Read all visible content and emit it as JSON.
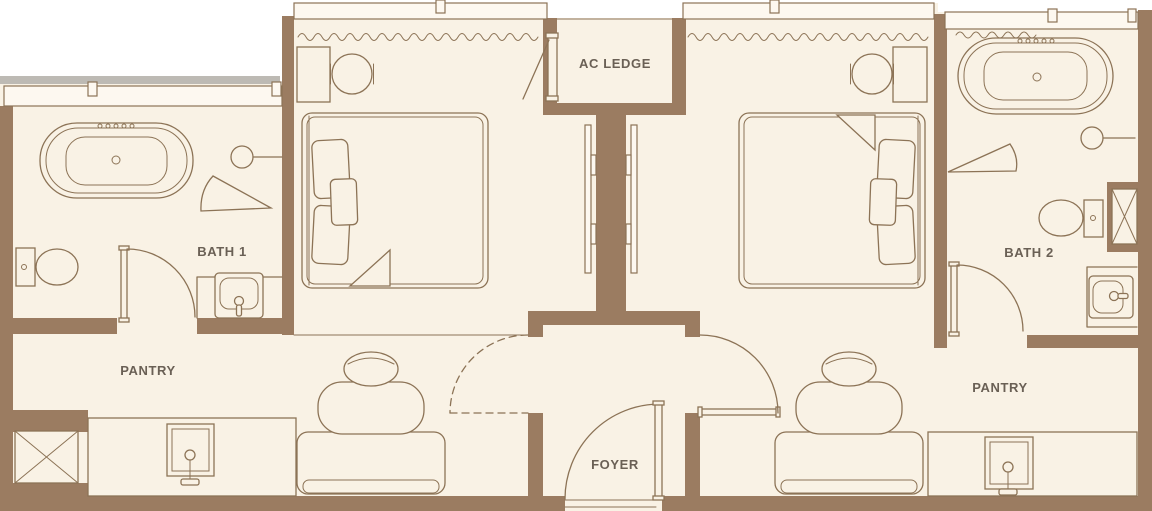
{
  "plan": {
    "type": "apartment-floor-plan",
    "rooms": {
      "bath1": "BATH 1",
      "bath2": "BATH 2",
      "pantry_left": "PANTRY",
      "pantry_right": "PANTRY",
      "ac_ledge": "AC LEDGE",
      "foyer": "FOYER"
    },
    "fixtures": [
      "bathtub-left",
      "bathtub-right",
      "shower-head-left",
      "shower-head-right",
      "shower-screen-left",
      "shower-screen-right",
      "toilet-left",
      "toilet-right",
      "vanity-sink-left",
      "vanity-sink-right",
      "bed-left",
      "bed-right",
      "desk-left",
      "desk-right",
      "stool-left",
      "stool-right",
      "armchair-left",
      "armchair-right",
      "kitchen-counter-left",
      "kitchen-counter-right",
      "kitchen-sink-left",
      "kitchen-sink-right",
      "service-shaft-left",
      "service-shaft-right",
      "curtain-left",
      "curtain-right",
      "curtain-bath2",
      "door-bath1",
      "door-bath2",
      "door-entry",
      "door-pantry-right",
      "door-pantry-left-dashed",
      "wall-panel-left",
      "wall-panel-right"
    ],
    "colors": {
      "outside": "#ffffff",
      "floor": "#f9f2e5",
      "wall": "#9b7c61",
      "line": "#8c7356",
      "label": "#6a6055",
      "shadow": "#bdbab4",
      "window": "#fdf8f0"
    }
  }
}
